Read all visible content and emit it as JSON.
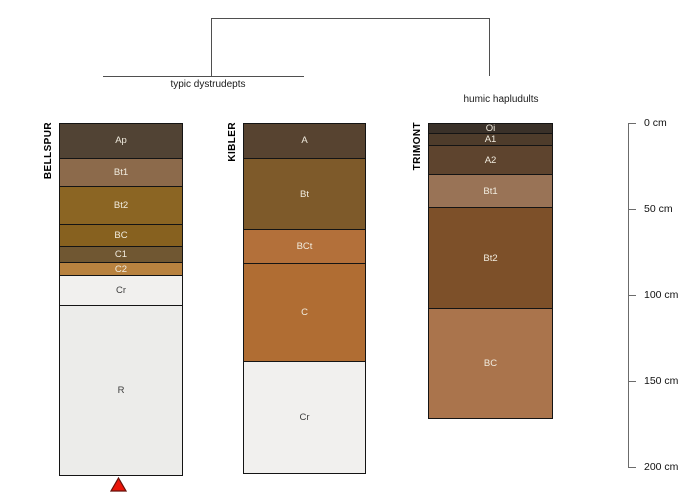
{
  "figure": {
    "kind": "soil profile comparison sketch with dendrogram",
    "background": "#ffffff"
  },
  "chart_data": {
    "type": "bar",
    "subtype": "stacked soil-horizon depth columns grouped by a dendrogram",
    "title": "",
    "ylabel": "depth (cm)",
    "ylim": [
      0,
      200
    ],
    "grid": false,
    "depth_ticks_cm": [
      0,
      50,
      100,
      150,
      200
    ],
    "depth_tick_labels": [
      "0 cm",
      "50 cm",
      "100 cm",
      "150 cm",
      "200 cm"
    ],
    "dendrogram": {
      "groups": [
        {
          "label": "typic dystrudepts",
          "members": [
            "BELLSPUR",
            "KIBLER"
          ]
        },
        {
          "label": "humic hapludults",
          "members": [
            "TRIMONT"
          ]
        }
      ]
    },
    "profiles": [
      {
        "name": "BELLSPUR",
        "group": "typic dystrudepts",
        "horizons": [
          {
            "name": "Ap",
            "top_cm": 0,
            "bottom_cm": 20,
            "color": "#514334"
          },
          {
            "name": "Bt1",
            "top_cm": 20,
            "bottom_cm": 36,
            "color": "#8c6a4b"
          },
          {
            "name": "Bt2",
            "top_cm": 36,
            "bottom_cm": 58,
            "color": "#8b6523"
          },
          {
            "name": "BC",
            "top_cm": 58,
            "bottom_cm": 71,
            "color": "#87611f"
          },
          {
            "name": "C1",
            "top_cm": 71,
            "bottom_cm": 80,
            "color": "#705732"
          },
          {
            "name": "C2",
            "top_cm": 80,
            "bottom_cm": 88,
            "color": "#b8823f"
          },
          {
            "name": "Cr",
            "top_cm": 88,
            "bottom_cm": 105,
            "color": "#f1f0ee"
          },
          {
            "name": "R",
            "top_cm": 105,
            "bottom_cm": 204,
            "color": "#ececea"
          }
        ]
      },
      {
        "name": "KIBLER",
        "group": "typic dystrudepts",
        "horizons": [
          {
            "name": "A",
            "top_cm": 0,
            "bottom_cm": 20,
            "color": "#574330"
          },
          {
            "name": "Bt",
            "top_cm": 20,
            "bottom_cm": 61,
            "color": "#7e5a2a"
          },
          {
            "name": "BCt",
            "top_cm": 61,
            "bottom_cm": 81,
            "color": "#b3703a"
          },
          {
            "name": "C",
            "top_cm": 81,
            "bottom_cm": 138,
            "color": "#b06d33"
          },
          {
            "name": "Cr",
            "top_cm": 138,
            "bottom_cm": 203,
            "color": "#f1f0ee"
          }
        ]
      },
      {
        "name": "TRIMONT",
        "group": "humic hapludults",
        "horizons": [
          {
            "name": "Oi",
            "top_cm": 0,
            "bottom_cm": 5,
            "color": "#3a3129"
          },
          {
            "name": "A1",
            "top_cm": 5,
            "bottom_cm": 12,
            "color": "#4e3c2b"
          },
          {
            "name": "A2",
            "top_cm": 12,
            "bottom_cm": 29,
            "color": "#5e442e"
          },
          {
            "name": "Bt1",
            "top_cm": 29,
            "bottom_cm": 48,
            "color": "#997356"
          },
          {
            "name": "Bt2",
            "top_cm": 48,
            "bottom_cm": 107,
            "color": "#7d5029"
          },
          {
            "name": "BC",
            "top_cm": 107,
            "bottom_cm": 171,
            "color": "#aa744c"
          }
        ]
      }
    ],
    "marker": {
      "shape": "triangle-up",
      "fill": "#ea1509",
      "stroke": "#66110a",
      "points_to": "BELLSPUR"
    }
  }
}
